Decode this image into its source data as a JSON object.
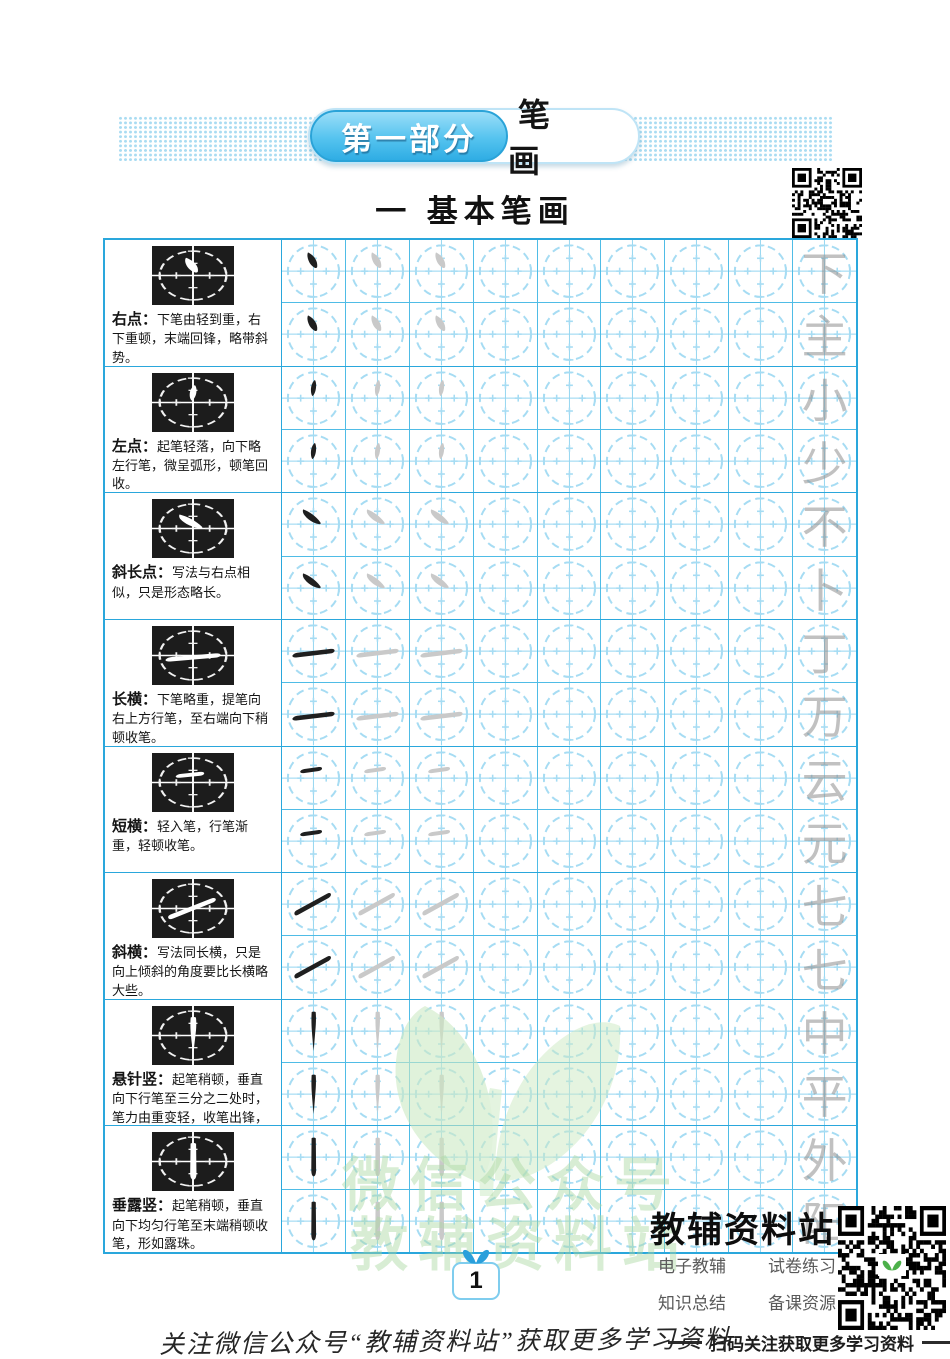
{
  "header": {
    "part_badge": {
      "label": "第一部分",
      "title": "笔 画"
    },
    "section_title": "一 基本笔画"
  },
  "ui": {
    "colon": "："
  },
  "rows": [
    {
      "name": "右点",
      "stroke": "right-dot",
      "desc": "下笔由轻到重，右下重顿，末端回锋，略带斜势。",
      "examples": [
        "下",
        "主"
      ]
    },
    {
      "name": "左点",
      "stroke": "left-dot",
      "desc": "起笔轻落，向下略左行笔，微呈弧形，顿笔回收。",
      "examples": [
        "小",
        "少"
      ]
    },
    {
      "name": "斜长点",
      "stroke": "oblique-long-dot",
      "desc": "写法与右点相似，只是形态略长。",
      "examples": [
        "不",
        "卜"
      ]
    },
    {
      "name": "长横",
      "stroke": "long-horizontal",
      "desc": "下笔略重，提笔向右上方行笔，至右端向下稍顿收笔。",
      "examples": [
        "丁",
        "万"
      ]
    },
    {
      "name": "短横",
      "stroke": "short-horizontal",
      "desc": "轻入笔，行笔渐重，轻顿收笔。",
      "examples": [
        "云",
        "元"
      ]
    },
    {
      "name": "斜横",
      "stroke": "oblique-horizontal",
      "desc": "写法同长横，只是向上倾斜的角度要比长横略大些。",
      "examples": [
        "七",
        "七"
      ]
    },
    {
      "name": "悬针竖",
      "stroke": "needle-vertical",
      "desc": "起笔稍顿，垂直向下行笔至三分之二处时，笔力由重变轻，收笔出锋，形如银针。",
      "examples": [
        "中",
        "平"
      ]
    },
    {
      "name": "垂露竖",
      "stroke": "dew-vertical",
      "desc": "起笔稍顿，垂直向下均匀行笔至末端稍顿收笔，形如露珠。",
      "examples": [
        "外",
        "阳"
      ]
    }
  ],
  "practice": {
    "columns_per_row": 9,
    "subrows_per_stroke": 2,
    "ink_column": 1,
    "trace_columns": [
      2,
      3
    ],
    "example_column": 9
  },
  "watermark": {
    "line1": "微信公众号",
    "line2": "教辅资料站"
  },
  "footer": {
    "page_number": "1",
    "site_name": "教辅资料站",
    "services": [
      "电子教辅",
      "试卷练习",
      "知识总结",
      "备课资源"
    ],
    "scan_hint": "扫码关注获取更多学习资料",
    "bottom_note": "关注微信公众号“教辅资料站”获取更多学习资料"
  },
  "colors": {
    "table_border": "#2aa7dc",
    "cell_line": "#4fbce6",
    "grid_guide": "#a6dcf3",
    "badge_blue": "#3fb6e8",
    "ink": "#1f1f1f",
    "trace_gray": "#c9c9c9",
    "watermark_green": "#abd9a2"
  }
}
